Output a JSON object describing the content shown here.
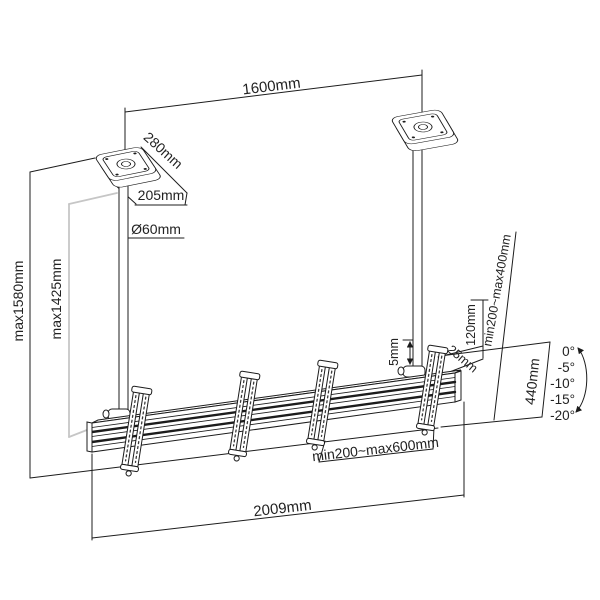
{
  "diagram": {
    "type": "technical_drawing",
    "subject": "dual-pole ceiling TV mount with rail and tilt brackets",
    "labels": {
      "span": "1600mm",
      "plate_side": "280mm",
      "plate_front": "205mm",
      "pole_diameter": "Ø60mm",
      "max_drop_overall": "max1580mm",
      "max_drop_pole": "max1425mm",
      "fine_adjust": "5mm",
      "rail_offset": "120mm",
      "hook_gap": "25mm",
      "vesa_vertical_range": "min200~max400mm",
      "vesa_horizontal_range": "min200~max600mm",
      "rail_length": "2009mm",
      "bracket_span": "440mm",
      "tilt_angles": [
        "0°",
        "-5°",
        "-10°",
        "-15°",
        "-20°"
      ]
    },
    "colors": {
      "line": "#1c1c1c",
      "text": "#222222",
      "light_extension_line": "#c6c6c6",
      "background": "#ffffff"
    }
  }
}
